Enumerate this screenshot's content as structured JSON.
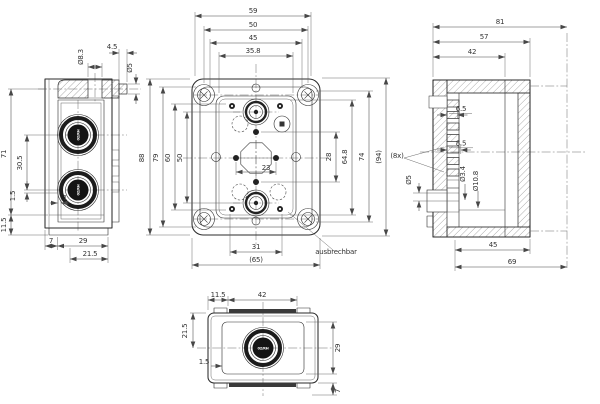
{
  "drawing_title": "enclosure-technical-drawing",
  "side": {
    "d83": "Ø8.3",
    "l45": "4.5",
    "d5": "Ø5",
    "v71": "71",
    "v305": "30.5",
    "v15": "1.5",
    "v115": "11.5",
    "w1": "1",
    "b7": "7",
    "b29": "29",
    "b215": "21.5",
    "gland": "02/RH"
  },
  "front": {
    "t59": "59",
    "t50": "50",
    "t45": "45",
    "t358": "35.8",
    "l88": "88",
    "l79": "79",
    "l60": "60",
    "l50": "50",
    "r28": "28",
    "r648": "64.8",
    "r74": "74",
    "r94": "(94)",
    "oct23": "23",
    "b31": "31",
    "b65": "(65)",
    "note": "ausbrechbar"
  },
  "section": {
    "t81": "81",
    "t57": "57",
    "t42": "42",
    "s65": "6.5",
    "s85": "8.5",
    "d34": "Ø3.4",
    "d108": "Ø10.8",
    "d5": "Ø5",
    "count": "(8x)",
    "b45": "45",
    "b69": "69"
  },
  "bottom": {
    "t115": "11.5",
    "t42": "42",
    "l215": "21.5",
    "w15": "1.5",
    "r29": "29",
    "b7": "7",
    "gland": "02/RH"
  }
}
